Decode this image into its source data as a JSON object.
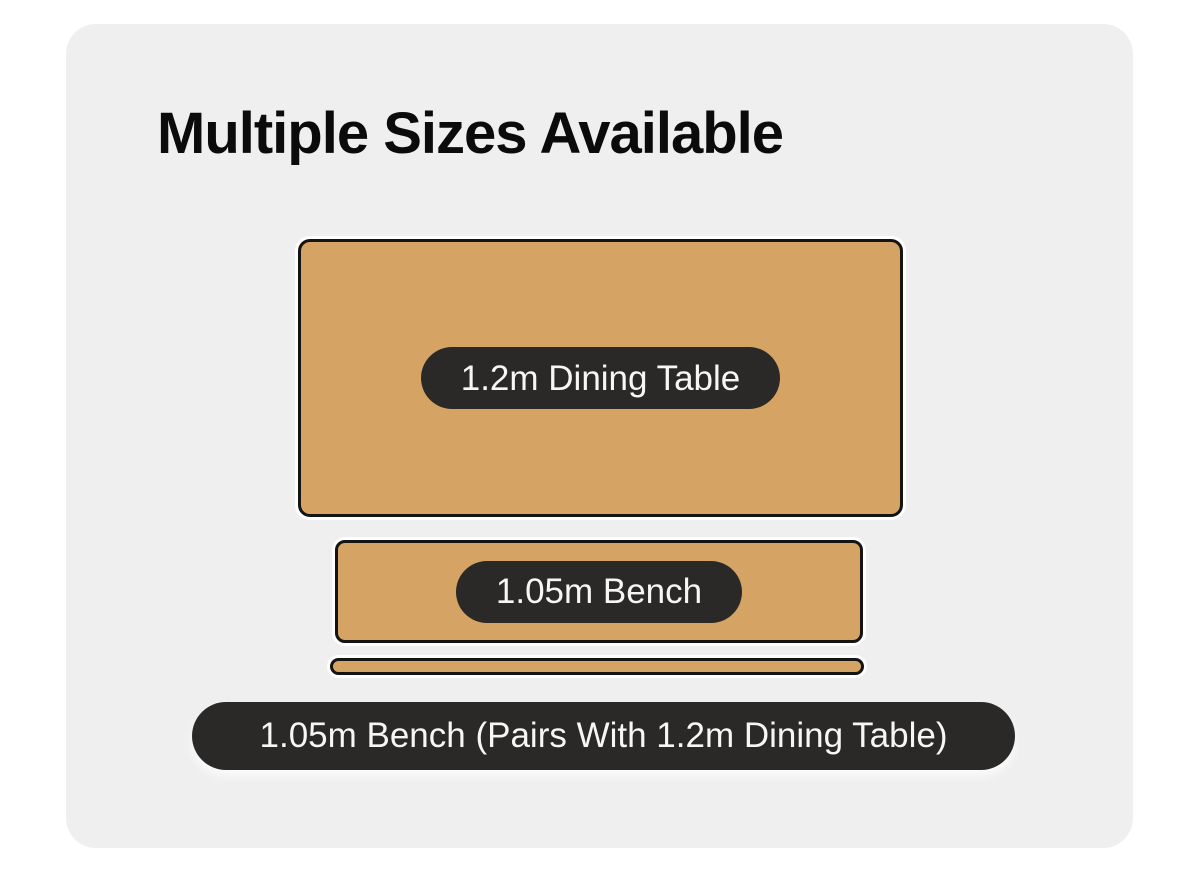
{
  "title": "Multiple Sizes Available",
  "shapes": {
    "table": {
      "label": "1.2m Dining Table"
    },
    "bench": {
      "label": "1.05m Bench"
    },
    "bench_side_view": {
      "label": ""
    }
  },
  "caption": "1.05m Bench (Pairs With 1.2m Dining Table)",
  "colors": {
    "page_bg": "#ffffff",
    "card_bg": "#efefef",
    "wood": "#d5a364",
    "outline": "#141414",
    "label_bg": "#2b2928",
    "label_text": "#f7f6f4",
    "title_text": "#0b0b0b"
  }
}
